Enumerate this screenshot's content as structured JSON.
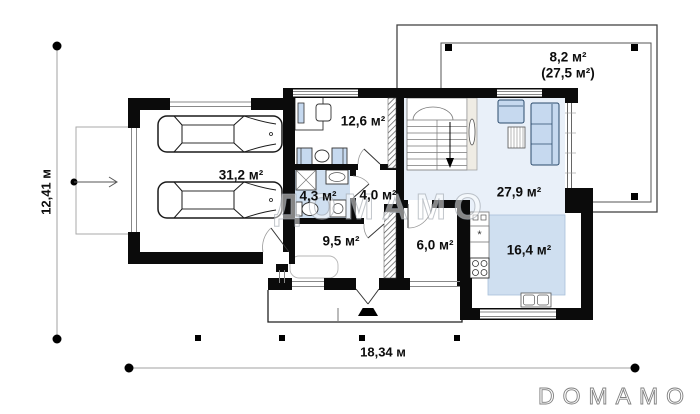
{
  "plan": {
    "rooms": [
      {
        "name": "garage",
        "area": "31,2 м²"
      },
      {
        "name": "office",
        "area": "12,6 м²"
      },
      {
        "name": "bathroom",
        "area": "4,3 м²"
      },
      {
        "name": "hallway",
        "area": "4,0 м²"
      },
      {
        "name": "living-room",
        "area": "27,9 м²"
      },
      {
        "name": "entrance-hall",
        "area": "9,5 м²"
      },
      {
        "name": "pantry",
        "area": "6,0 м²"
      },
      {
        "name": "kitchen",
        "area": "16,4 м²"
      }
    ],
    "terrace": {
      "area": "8,2 м²",
      "total_area": "(27,5 м²)"
    },
    "dimensions": {
      "width": "18,34 м",
      "depth": "12,41 м"
    },
    "fridge_symbol": "*"
  },
  "watermark": {
    "center": "ДОМАМО",
    "logo": "DOMAMO"
  },
  "colors": {
    "wall": "#0b0b0b",
    "floor_blue": "#cfdff0",
    "floor_light": "#e9f0f9",
    "furniture_blue": "#c6d9ef",
    "line_gray": "#999999"
  }
}
